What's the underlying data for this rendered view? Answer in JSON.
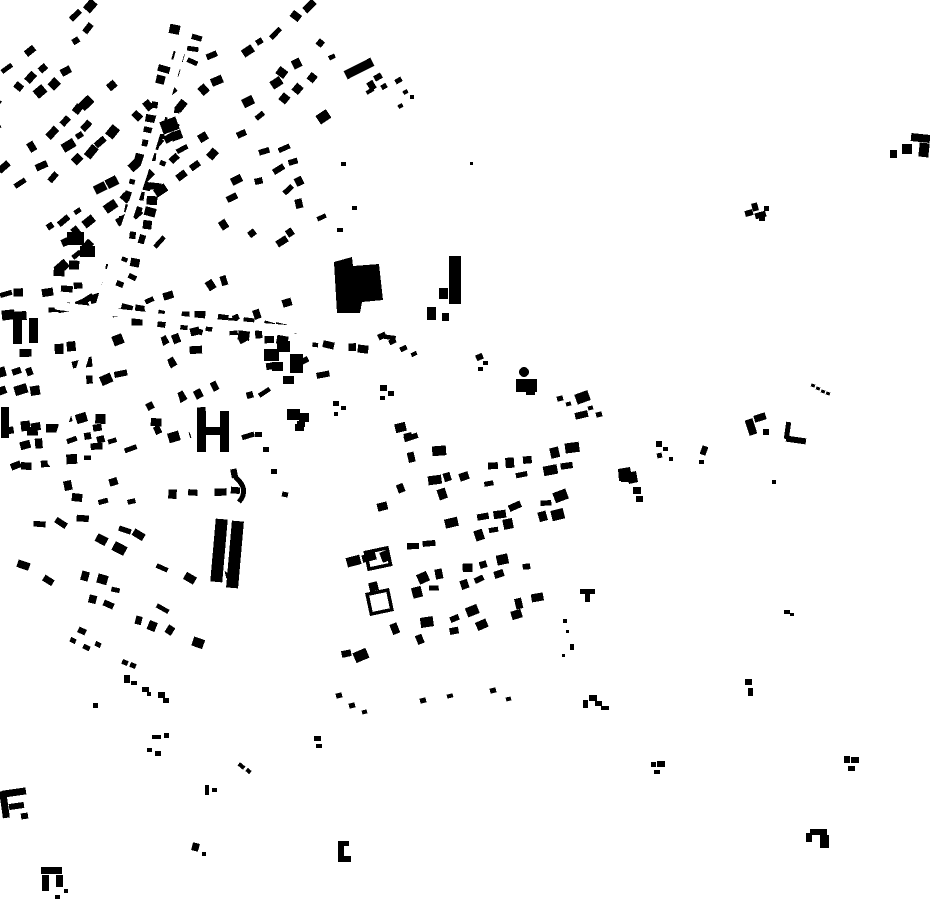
{
  "style": {
    "background_color": "#ffffff",
    "building_color": "#000000",
    "canvas_width": 930,
    "canvas_height": 924
  },
  "map": {
    "seed": 1337,
    "clusters": [
      {
        "id": "nw-fabric",
        "cx": 88,
        "cy": 146,
        "w": 200,
        "h": 238,
        "angle": -38,
        "cellU": 15,
        "cellV": 19,
        "blockU": 5,
        "blockV": 4,
        "density": 0.8,
        "bw": 9.5,
        "bh": 7,
        "jitter": 2.8,
        "rotJitter": 15
      },
      {
        "id": "north-center",
        "cx": 258,
        "cy": 90,
        "w": 220,
        "h": 126,
        "angle": -38,
        "cellU": 15,
        "cellV": 19,
        "blockU": 4,
        "blockV": 3,
        "density": 0.72,
        "bw": 9.5,
        "bh": 7,
        "jitter": 3,
        "rotJitter": 18
      },
      {
        "id": "main-road-strip",
        "cx": 148,
        "cy": 172,
        "w": 34,
        "h": 300,
        "angle": 15,
        "cellU": 12,
        "cellV": 13,
        "blockU": 0,
        "blockV": 6,
        "density": 0.8,
        "bw": 8.5,
        "bh": 6.5,
        "jitter": 2.2,
        "rotJitter": 12
      },
      {
        "id": "west-band",
        "cx": 62,
        "cy": 390,
        "w": 132,
        "h": 258,
        "angle": -8,
        "cellU": 15,
        "cellV": 19,
        "blockU": 4,
        "blockV": 4,
        "density": 0.7,
        "bw": 9,
        "bh": 7,
        "jitter": 3,
        "rotJitter": 14
      },
      {
        "id": "mid-center",
        "cx": 214,
        "cy": 350,
        "w": 236,
        "h": 188,
        "angle": -18,
        "cellU": 16,
        "cellV": 20,
        "blockU": 4,
        "blockV": 3,
        "density": 0.55,
        "bw": 9.5,
        "bh": 7,
        "jitter": 3.4,
        "rotJitter": 16
      },
      {
        "id": "road-east-strip",
        "cx": 246,
        "cy": 330,
        "w": 300,
        "h": 28,
        "angle": 7,
        "cellU": 12,
        "cellV": 13,
        "blockU": 7,
        "blockV": 0,
        "density": 0.82,
        "bw": 8.5,
        "bh": 6.5,
        "jitter": 2.2,
        "rotJitter": 10
      },
      {
        "id": "south-mid",
        "cx": 150,
        "cy": 472,
        "w": 238,
        "h": 120,
        "angle": -4,
        "cellU": 15,
        "cellV": 19,
        "blockU": 4,
        "blockV": 3,
        "density": 0.6,
        "bw": 9,
        "bh": 7,
        "jitter": 3,
        "rotJitter": 15
      },
      {
        "id": "southwest-grid",
        "cx": 120,
        "cy": 582,
        "w": 208,
        "h": 120,
        "angle": 24,
        "cellU": 16,
        "cellV": 19,
        "blockU": 4,
        "blockV": 3,
        "density": 0.7,
        "bw": 9.5,
        "bh": 7,
        "jitter": 2.8,
        "rotJitter": 13
      },
      {
        "id": "central-grid",
        "cx": 455,
        "cy": 538,
        "w": 225,
        "h": 255,
        "angle": -13,
        "colTilt": -14,
        "cellU": 16,
        "cellV": 17,
        "blockU": 4,
        "blockV": 3,
        "density": 0.72,
        "bw": 10,
        "bh": 7.5,
        "jitter": 3,
        "rotJitter": 12
      },
      {
        "id": "center-gap",
        "cx": 268,
        "cy": 204,
        "w": 150,
        "h": 108,
        "angle": -30,
        "cellU": 18,
        "cellV": 20,
        "blockU": 0,
        "blockV": 0,
        "density": 0.45,
        "bw": 8.5,
        "bh": 6.5,
        "jitter": 4,
        "rotJitter": 18
      }
    ],
    "roads": [
      {
        "id": "road-main-diagonal",
        "points": "193,10 150,152 106,286 52,462",
        "width": 9
      },
      {
        "id": "road-east",
        "points": "58,306 200,322 312,331 434,351",
        "width": 8
      },
      {
        "id": "road-south",
        "points": "148,308 176,400 205,505 228,600",
        "width": 7
      }
    ],
    "landmarks": [
      {
        "name": "large-central-building",
        "poly": "334,262 352,257 353,266 379,264 383,300 362,302 360,313 337,313"
      },
      {
        "name": "tower-block",
        "rects": [
          [
            449,
            256,
            12,
            48,
            0
          ],
          [
            439,
            288,
            9,
            11,
            0
          ],
          [
            427,
            307,
            9,
            13,
            0
          ],
          [
            442,
            313,
            7,
            8,
            0
          ]
        ]
      },
      {
        "name": "dot-building",
        "circle": [
          524,
          372,
          5
        ],
        "rects": [
          [
            516,
            379,
            21,
            13,
            0
          ],
          [
            526,
            391,
            9,
            4,
            0
          ]
        ]
      },
      {
        "name": "h-building",
        "rects": [
          [
            197,
            411,
            9,
            41,
            0
          ],
          [
            220,
            411,
            9,
            41,
            0
          ],
          [
            205,
            427,
            16,
            8,
            0
          ]
        ]
      },
      {
        "name": "arc-building",
        "path": "M 235,477 Q 250,489 239,502",
        "sw": 5
      },
      {
        "name": "twin-bar-buildings",
        "rects": [
          [
            213,
            519,
            12,
            63,
            5
          ],
          [
            229,
            521,
            12,
            67,
            5
          ]
        ]
      },
      {
        "name": "west-tall-bars",
        "rects": [
          [
            13,
            319,
            9,
            25,
            0
          ],
          [
            29,
            318,
            9,
            25,
            0
          ],
          [
            1,
            407,
            8,
            31,
            0
          ]
        ]
      },
      {
        "name": "east-chunk-row",
        "rects": [
          [
            264,
            349,
            15,
            12,
            0
          ],
          [
            277,
            341,
            13,
            11,
            0
          ],
          [
            272,
            362,
            11,
            9,
            0
          ],
          [
            290,
            354,
            13,
            19,
            0
          ],
          [
            283,
            376,
            11,
            8,
            0
          ],
          [
            287,
            409,
            13,
            11,
            0
          ],
          [
            299,
            413,
            10,
            9,
            0
          ],
          [
            295,
            424,
            9,
            7,
            0
          ]
        ]
      },
      {
        "name": "nw-chunks",
        "rects": [
          [
            67,
            232,
            17,
            13,
            0
          ],
          [
            80,
            246,
            15,
            11,
            0
          ],
          [
            161,
            119,
            17,
            13,
            -20
          ],
          [
            171,
            131,
            11,
            9,
            -20
          ]
        ]
      },
      {
        "name": "courtyard-frame-1",
        "frame": [
          367,
          550,
          22,
          17,
          -12
        ]
      },
      {
        "name": "courtyard-frame-2",
        "frame": [
          369,
          592,
          21,
          20,
          -12
        ]
      },
      {
        "name": "diagonal-bar",
        "rects": [
          [
            344,
            64,
            30,
            9,
            -27
          ],
          [
            368,
            81,
            7,
            9,
            -30
          ],
          [
            374,
            74,
            8,
            6,
            -30
          ],
          [
            381,
            84,
            6,
            5,
            -30
          ],
          [
            366,
            89,
            8,
            4,
            -30
          ]
        ]
      },
      {
        "name": "sw-f-building",
        "rects": [
          [
            1,
            791,
            7,
            27,
            -8
          ],
          [
            3,
            789,
            23,
            7,
            -8
          ],
          [
            9,
            803,
            15,
            6,
            -8
          ],
          [
            21,
            813,
            7,
            6,
            -8
          ]
        ]
      },
      {
        "name": "sw-pi-building",
        "rects": [
          [
            41,
            867,
            21,
            7,
            0
          ],
          [
            42,
            875,
            7,
            16,
            0
          ],
          [
            56,
            875,
            7,
            12,
            0
          ],
          [
            64,
            889,
            4,
            4,
            0
          ]
        ]
      },
      {
        "name": "south-bracket",
        "rects": [
          [
            338,
            841,
            6,
            20,
            0
          ],
          [
            338,
            841,
            11,
            5,
            0
          ],
          [
            338,
            856,
            13,
            6,
            0
          ]
        ]
      },
      {
        "name": "ne-f-building",
        "rects": [
          [
            890,
            150,
            7,
            8,
            0
          ],
          [
            902,
            144,
            10,
            10,
            0
          ],
          [
            911,
            134,
            19,
            8,
            6
          ],
          [
            919,
            143,
            10,
            14,
            6
          ]
        ]
      },
      {
        "name": "ne-t-cluster",
        "rects": [
          [
            745,
            210,
            8,
            6,
            -15
          ],
          [
            752,
            203,
            6,
            8,
            -15
          ],
          [
            755,
            212,
            11,
            6,
            -15
          ],
          [
            764,
            206,
            5,
            5,
            0
          ],
          [
            759,
            217,
            6,
            4,
            0
          ]
        ]
      },
      {
        "name": "dotted-row",
        "rects": [
          [
            811,
            384,
            4,
            3,
            20
          ],
          [
            816,
            387,
            4,
            3,
            20
          ],
          [
            821,
            390,
            4,
            3,
            20
          ],
          [
            826,
            392,
            4,
            3,
            20
          ]
        ]
      },
      {
        "name": "east-c-building",
        "rects": [
          [
            747,
            419,
            8,
            16,
            -18
          ],
          [
            754,
            414,
            12,
            7,
            -18
          ],
          [
            763,
            429,
            6,
            6,
            0
          ]
        ]
      },
      {
        "name": "east-l-building",
        "rects": [
          [
            785,
            422,
            5,
            17,
            8
          ],
          [
            786,
            437,
            20,
            6,
            8
          ]
        ]
      },
      {
        "name": "east-dark-blob",
        "poly": "618,469 630,467 631,472 636,471 638,482 629,484 628,480 619,481",
        "rects": [
          [
            621,
            472,
            12,
            10,
            0
          ],
          [
            633,
            487,
            8,
            7,
            0
          ],
          [
            636,
            496,
            7,
            6,
            0
          ]
        ]
      },
      {
        "name": "se-pi-building",
        "rects": [
          [
            806,
            833,
            6,
            9,
            0
          ],
          [
            810,
            829,
            17,
            6,
            0
          ],
          [
            820,
            835,
            9,
            13,
            0
          ]
        ]
      }
    ],
    "scattered": [
      [
        656,
        441,
        6,
        6,
        0
      ],
      [
        663,
        447,
        5,
        4,
        0
      ],
      [
        657,
        453,
        5,
        5,
        -10
      ],
      [
        669,
        457,
        4,
        4,
        0
      ],
      [
        701,
        446,
        6,
        9,
        20
      ],
      [
        699,
        460,
        5,
        4,
        0
      ],
      [
        772,
        480,
        4,
        4,
        0
      ],
      [
        580,
        589,
        15,
        5,
        0
      ],
      [
        585,
        593,
        5,
        9,
        0
      ],
      [
        563,
        619,
        4,
        4,
        0
      ],
      [
        566,
        630,
        3,
        3,
        0
      ],
      [
        570,
        644,
        4,
        6,
        0
      ],
      [
        562,
        654,
        3,
        3,
        0
      ],
      [
        583,
        700,
        5,
        8,
        0
      ],
      [
        589,
        695,
        8,
        6,
        0
      ],
      [
        595,
        701,
        7,
        5,
        0
      ],
      [
        601,
        706,
        8,
        4,
        0
      ],
      [
        745,
        679,
        7,
        6,
        0
      ],
      [
        748,
        688,
        5,
        8,
        0
      ],
      [
        651,
        762,
        5,
        5,
        0
      ],
      [
        657,
        761,
        8,
        6,
        0
      ],
      [
        654,
        770,
        6,
        4,
        0
      ],
      [
        844,
        756,
        6,
        7,
        0
      ],
      [
        851,
        757,
        8,
        6,
        0
      ],
      [
        848,
        766,
        7,
        5,
        0
      ],
      [
        784,
        610,
        6,
        4,
        0
      ],
      [
        790,
        613,
        4,
        3,
        0
      ],
      [
        122,
        660,
        6,
        5,
        20
      ],
      [
        130,
        663,
        6,
        5,
        20
      ],
      [
        124,
        675,
        6,
        8,
        0
      ],
      [
        131,
        681,
        6,
        4,
        0
      ],
      [
        142,
        687,
        7,
        5,
        0
      ],
      [
        147,
        692,
        4,
        4,
        0
      ],
      [
        158,
        692,
        7,
        6,
        0
      ],
      [
        163,
        698,
        6,
        5,
        0
      ],
      [
        152,
        735,
        9,
        4,
        0
      ],
      [
        164,
        733,
        5,
        5,
        0
      ],
      [
        314,
        736,
        7,
        5,
        0
      ],
      [
        316,
        744,
        6,
        4,
        0
      ],
      [
        238,
        764,
        7,
        4,
        40
      ],
      [
        246,
        769,
        5,
        4,
        40
      ],
      [
        205,
        785,
        4,
        10,
        0
      ],
      [
        212,
        788,
        5,
        4,
        0
      ],
      [
        93,
        703,
        5,
        5,
        0
      ],
      [
        147,
        748,
        5,
        4,
        0
      ],
      [
        155,
        751,
        6,
        5,
        0
      ],
      [
        192,
        843,
        7,
        8,
        15
      ],
      [
        202,
        852,
        4,
        4,
        0
      ],
      [
        55,
        895,
        5,
        4,
        0
      ],
      [
        255,
        432,
        7,
        5,
        0
      ],
      [
        263,
        447,
        6,
        5,
        0
      ],
      [
        271,
        469,
        6,
        5,
        0
      ],
      [
        282,
        492,
        6,
        5,
        10
      ],
      [
        297,
        421,
        8,
        6,
        0
      ],
      [
        378,
        333,
        8,
        6,
        -25
      ],
      [
        389,
        339,
        7,
        5,
        -25
      ],
      [
        400,
        346,
        7,
        5,
        -25
      ],
      [
        411,
        352,
        6,
        4,
        -25
      ],
      [
        380,
        385,
        7,
        6,
        0
      ],
      [
        388,
        391,
        6,
        5,
        0
      ],
      [
        380,
        396,
        5,
        4,
        0
      ],
      [
        333,
        401,
        6,
        5,
        0
      ],
      [
        341,
        406,
        5,
        4,
        0
      ],
      [
        334,
        412,
        4,
        4,
        0
      ],
      [
        476,
        354,
        7,
        6,
        -25
      ],
      [
        483,
        361,
        5,
        4,
        0
      ],
      [
        478,
        367,
        5,
        4,
        0
      ],
      [
        470,
        162,
        3,
        3,
        0
      ],
      [
        336,
        693,
        6,
        5,
        -14
      ],
      [
        349,
        703,
        6,
        5,
        -14
      ],
      [
        362,
        710,
        5,
        4,
        -14
      ],
      [
        420,
        698,
        6,
        5,
        -14
      ],
      [
        447,
        694,
        6,
        4,
        -14
      ],
      [
        490,
        688,
        6,
        5,
        -14
      ],
      [
        506,
        697,
        5,
        4,
        -14
      ],
      [
        557,
        396,
        6,
        5,
        -14
      ],
      [
        566,
        402,
        5,
        4,
        -14
      ],
      [
        577,
        398,
        6,
        5,
        -14
      ],
      [
        588,
        406,
        5,
        4,
        -14
      ],
      [
        596,
        412,
        6,
        5,
        -14
      ],
      [
        395,
        78,
        7,
        5,
        -30
      ],
      [
        403,
        90,
        5,
        4,
        -30
      ],
      [
        398,
        104,
        5,
        4,
        -30
      ],
      [
        410,
        95,
        4,
        4,
        0
      ],
      [
        341,
        162,
        5,
        4,
        0
      ],
      [
        352,
        206,
        5,
        4,
        0
      ],
      [
        337,
        228,
        6,
        4,
        0
      ],
      [
        395,
        423,
        11,
        9,
        -14
      ],
      [
        404,
        433,
        8,
        6,
        -14
      ],
      [
        78,
        628,
        8,
        6,
        25
      ],
      [
        70,
        638,
        6,
        5,
        25
      ],
      [
        83,
        645,
        7,
        5,
        25
      ],
      [
        95,
        642,
        6,
        5,
        25
      ]
    ]
  }
}
